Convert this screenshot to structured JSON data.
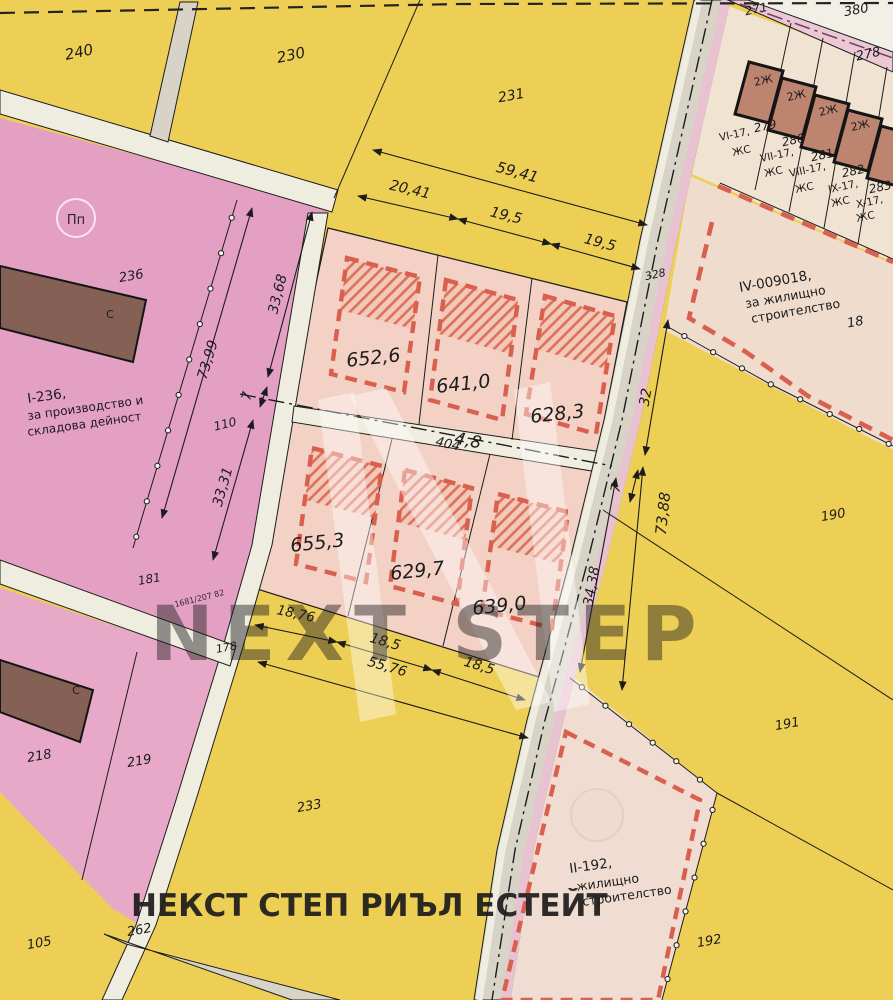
{
  "title": "Cadastral regulation plan with plots",
  "colors": {
    "yellow": "#eecf55",
    "pink_area": "#e4a0c3",
    "pink_area2": "#e7a9c7",
    "peach_block": "#f3d1c5",
    "peach_hatch_bg": "#f2c9b9",
    "tan_strip": "#f1e3d2",
    "tan_iv": "#efdccd",
    "tan_ii": "#f0dcd0",
    "road_gray": "#d7d4c7",
    "road_light": "#efece0",
    "road_pink_stripe": "#e8c2d0",
    "pink_road": "#ecc8d5",
    "paper": "#f2efe7",
    "building_terracotta": "#bd8570",
    "building_dark_brown": "#846055",
    "red_regulation": "#d95f4f",
    "hatch_red": "#dd6f5a",
    "purple_centerline": "#6e4666",
    "ink": "#1c1c1c",
    "agency_red": "#c5473a",
    "ref_red": "#d4606e"
  },
  "labels": [
    {
      "n": "parcel-240",
      "t": "240",
      "x": 80,
      "y": 57,
      "s": 15,
      "r": -12,
      "i": 1
    },
    {
      "n": "parcel-230",
      "t": "230",
      "x": 292,
      "y": 60,
      "s": 15,
      "r": -12,
      "i": 1
    },
    {
      "n": "parcel-231",
      "t": "231",
      "x": 512,
      "y": 100,
      "s": 14,
      "r": -10,
      "i": 1
    },
    {
      "n": "parcel-380",
      "t": "380",
      "x": 857,
      "y": 14,
      "s": 13,
      "r": -10,
      "i": 1
    },
    {
      "n": "parcel-271",
      "t": "271",
      "x": 757,
      "y": 13,
      "s": 12,
      "r": -12,
      "i": 1
    },
    {
      "n": "parcel-278",
      "t": "278",
      "x": 869,
      "y": 58,
      "s": 13,
      "r": -12,
      "i": 1
    },
    {
      "n": "parcel-279",
      "t": "279",
      "x": 766,
      "y": 130,
      "s": 12,
      "r": -12,
      "i": 1
    },
    {
      "n": "parcel-280",
      "t": "280",
      "x": 794,
      "y": 144,
      "s": 12,
      "r": -12,
      "i": 1
    },
    {
      "n": "parcel-281",
      "t": "281",
      "x": 823,
      "y": 159,
      "s": 12,
      "r": -12,
      "i": 1
    },
    {
      "n": "parcel-282",
      "t": "282",
      "x": 854,
      "y": 175,
      "s": 12,
      "r": -12,
      "i": 1
    },
    {
      "n": "parcel-283",
      "t": "283",
      "x": 881,
      "y": 191,
      "s": 12,
      "r": -12,
      "i": 1
    },
    {
      "n": "parcel-18",
      "t": "18",
      "x": 856,
      "y": 326,
      "s": 13,
      "r": -10,
      "i": 1
    },
    {
      "n": "parcel-190",
      "t": "190",
      "x": 834,
      "y": 519,
      "s": 13,
      "r": -10,
      "i": 1
    },
    {
      "n": "parcel-191",
      "t": "191",
      "x": 788,
      "y": 728,
      "s": 13,
      "r": -10,
      "i": 1
    },
    {
      "n": "parcel-192",
      "t": "192",
      "x": 710,
      "y": 945,
      "s": 13,
      "r": -10,
      "i": 1
    },
    {
      "n": "parcel-236",
      "t": "236",
      "x": 132,
      "y": 280,
      "s": 13,
      "r": -10,
      "i": 1
    },
    {
      "n": "parcel-110",
      "t": "110",
      "x": 226,
      "y": 428,
      "s": 12,
      "r": -14,
      "i": 1
    },
    {
      "n": "parcel-181",
      "t": "181",
      "x": 150,
      "y": 583,
      "s": 12,
      "r": -10,
      "i": 1
    },
    {
      "n": "parcel-178",
      "t": "178",
      "x": 227,
      "y": 651,
      "s": 11,
      "r": -10,
      "i": 1
    },
    {
      "n": "parcel-218",
      "t": "218",
      "x": 40,
      "y": 760,
      "s": 13,
      "r": -10,
      "i": 1
    },
    {
      "n": "parcel-219",
      "t": "219",
      "x": 140,
      "y": 765,
      "s": 13,
      "r": -10,
      "i": 1
    },
    {
      "n": "parcel-233",
      "t": "233",
      "x": 310,
      "y": 810,
      "s": 13,
      "r": -10,
      "i": 1
    },
    {
      "n": "parcel-105",
      "t": "105",
      "x": 40,
      "y": 947,
      "s": 13,
      "r": -10,
      "i": 1
    },
    {
      "n": "parcel-262",
      "t": "262",
      "x": 140,
      "y": 934,
      "s": 13,
      "r": -10,
      "i": 1
    },
    {
      "n": "parcel-328",
      "t": "328",
      "x": 656,
      "y": 278,
      "s": 11,
      "r": -12,
      "i": 1
    },
    {
      "n": "road-404-label",
      "t": "404",
      "x": 447,
      "y": 448,
      "s": 13,
      "r": 13,
      "i": 1,
      "c": "#9b988b"
    },
    {
      "n": "zone-i236-line1",
      "t": "I-236,",
      "x": 28,
      "y": 403,
      "s": 13.5,
      "r": -8,
      "a": "s"
    },
    {
      "n": "zone-i236-line2",
      "t": "за производство и",
      "x": 28,
      "y": 420,
      "s": 12,
      "r": -8,
      "a": "s"
    },
    {
      "n": "zone-i236-line3",
      "t": "складова дейност",
      "x": 28,
      "y": 436,
      "s": 12,
      "r": -8,
      "a": "s"
    },
    {
      "n": "zone-iv-line1",
      "t": "IV-009018,",
      "x": 740,
      "y": 292,
      "s": 13.5,
      "r": -10,
      "a": "s"
    },
    {
      "n": "zone-iv-line2",
      "t": "за жилищно",
      "x": 746,
      "y": 308,
      "s": 12.5,
      "r": -10,
      "a": "s"
    },
    {
      "n": "zone-iv-line3",
      "t": "строителство",
      "x": 752,
      "y": 323,
      "s": 12.5,
      "r": -10,
      "a": "s"
    },
    {
      "n": "zone-ii-line1",
      "t": "II-192,",
      "x": 570,
      "y": 873,
      "s": 13.5,
      "r": -8,
      "a": "s"
    },
    {
      "n": "zone-ii-line2",
      "t": "жилищно",
      "x": 577,
      "y": 891,
      "s": 12.5,
      "r": -8,
      "a": "s"
    },
    {
      "n": "zone-ii-line3",
      "t": "строителство",
      "x": 583,
      "y": 906,
      "s": 12.5,
      "r": -8,
      "a": "s"
    },
    {
      "n": "plot-279-use",
      "t": "VI-17,",
      "x": 720,
      "y": 141,
      "s": 10.5,
      "r": -12,
      "a": "s"
    },
    {
      "n": "plot-279-zs",
      "t": "ЖС",
      "x": 733,
      "y": 156,
      "s": 10.5,
      "r": -12,
      "a": "s"
    },
    {
      "n": "plot-280-use",
      "t": "VII-17,",
      "x": 761,
      "y": 162,
      "s": 10.5,
      "r": -12,
      "a": "s"
    },
    {
      "n": "plot-280-zs",
      "t": "ЖС",
      "x": 765,
      "y": 177,
      "s": 10.5,
      "r": -12,
      "a": "s"
    },
    {
      "n": "plot-281-use",
      "t": "VIII-17,",
      "x": 790,
      "y": 177,
      "s": 10.5,
      "r": -12,
      "a": "s"
    },
    {
      "n": "plot-281-zs",
      "t": "ЖС",
      "x": 796,
      "y": 193,
      "s": 10.5,
      "r": -12,
      "a": "s"
    },
    {
      "n": "plot-282-use",
      "t": "IX-17,",
      "x": 829,
      "y": 193,
      "s": 10.5,
      "r": -12,
      "a": "s"
    },
    {
      "n": "plot-282-zs",
      "t": "ЖС",
      "x": 832,
      "y": 207,
      "s": 10.5,
      "r": -12,
      "a": "s"
    },
    {
      "n": "plot-283-use",
      "t": "X-17,",
      "x": 857,
      "y": 208,
      "s": 10.5,
      "r": -12,
      "a": "s"
    },
    {
      "n": "plot-283-zs",
      "t": "ЖС",
      "x": 857,
      "y": 222,
      "s": 10.5,
      "r": -12,
      "a": "s"
    },
    {
      "n": "building-2j-1",
      "t": "2Ж",
      "x": 764,
      "y": 84,
      "s": 11,
      "r": -12
    },
    {
      "n": "building-2j-2",
      "t": "2Ж",
      "x": 797,
      "y": 99,
      "s": 11,
      "r": -12
    },
    {
      "n": "building-2j-3",
      "t": "2Ж",
      "x": 829,
      "y": 114,
      "s": 11,
      "r": -12
    },
    {
      "n": "building-2j-4",
      "t": "2Ж",
      "x": 861,
      "y": 129,
      "s": 11,
      "r": -12
    },
    {
      "n": "building-c-1",
      "t": "С",
      "x": 110,
      "y": 318,
      "s": 11,
      "c": "#efd3d6"
    },
    {
      "n": "building-c-2",
      "t": "С",
      "x": 76,
      "y": 694,
      "s": 11,
      "c": "#efd3d6"
    },
    {
      "n": "area-652-6",
      "t": "652,6",
      "x": 374,
      "y": 364,
      "s": 19,
      "r": -6,
      "i": 1
    },
    {
      "n": "area-641-0",
      "t": "641,0",
      "x": 464,
      "y": 390,
      "s": 19,
      "r": -6,
      "i": 1
    },
    {
      "n": "area-628-3",
      "t": "628,3",
      "x": 558,
      "y": 420,
      "s": 19,
      "r": -6,
      "i": 1
    },
    {
      "n": "area-655-3",
      "t": "655,3",
      "x": 318,
      "y": 549,
      "s": 19,
      "r": -6,
      "i": 1
    },
    {
      "n": "area-629-7",
      "t": "629,7",
      "x": 418,
      "y": 577,
      "s": 19,
      "r": -6,
      "i": 1
    },
    {
      "n": "area-639-0",
      "t": "639,0",
      "x": 500,
      "y": 612,
      "s": 19,
      "r": -6,
      "i": 1
    },
    {
      "n": "dim-59-41",
      "t": "59,41",
      "x": 516,
      "y": 177,
      "s": 15,
      "r": 15,
      "i": 1
    },
    {
      "n": "dim-20-41",
      "t": "20,41",
      "x": 409,
      "y": 194,
      "s": 14.5,
      "r": 13,
      "i": 1
    },
    {
      "n": "dim-19-5-a",
      "t": "19,5",
      "x": 505,
      "y": 220,
      "s": 14.5,
      "r": 14,
      "i": 1
    },
    {
      "n": "dim-19-5-b",
      "t": "19,5",
      "x": 599,
      "y": 247,
      "s": 14.5,
      "r": 15,
      "i": 1
    },
    {
      "n": "dim-33-68",
      "t": "33,68",
      "x": 282,
      "y": 295,
      "s": 14,
      "r": -76,
      "i": 1
    },
    {
      "n": "dim-7-left",
      "t": "7",
      "x": 251,
      "y": 397,
      "s": 13,
      "r": -76,
      "i": 1
    },
    {
      "n": "dim-33-31",
      "t": "33,31",
      "x": 227,
      "y": 488,
      "s": 14,
      "r": -74,
      "i": 1
    },
    {
      "n": "dim-73-99",
      "t": "73,99",
      "x": 212,
      "y": 361,
      "s": 14,
      "r": -73,
      "i": 1
    },
    {
      "n": "dim-32",
      "t": "32",
      "x": 650,
      "y": 398,
      "s": 14,
      "r": -80,
      "i": 1
    },
    {
      "n": "dim-7-right",
      "t": "7",
      "x": 620,
      "y": 489,
      "s": 13,
      "r": -78,
      "i": 1
    },
    {
      "n": "dim-73-88",
      "t": "73,88",
      "x": 668,
      "y": 514,
      "s": 15,
      "r": -84,
      "i": 1
    },
    {
      "n": "dim-34-38",
      "t": "34,38",
      "x": 596,
      "y": 587,
      "s": 14,
      "r": -80,
      "i": 1
    },
    {
      "n": "dim-18-76",
      "t": "18,76",
      "x": 295,
      "y": 618,
      "s": 13.5,
      "r": 12,
      "i": 1
    },
    {
      "n": "dim-18-5-a",
      "t": "18,5",
      "x": 384,
      "y": 646,
      "s": 14,
      "r": 16,
      "i": 1
    },
    {
      "n": "dim-18-5-b",
      "t": "18,5",
      "x": 478,
      "y": 670,
      "s": 14,
      "r": 17,
      "i": 1
    },
    {
      "n": "dim-55-76",
      "t": "55,76",
      "x": 386,
      "y": 671,
      "s": 14,
      "r": 16,
      "i": 1
    },
    {
      "n": "dim-4-8",
      "t": "4,8",
      "x": 467,
      "y": 446,
      "s": 17,
      "r": 11,
      "i": 1
    },
    {
      "n": "wm-ref-number",
      "t": "1681/207 82",
      "x": 200,
      "y": 601,
      "s": 8,
      "r": -14,
      "c": "#d4606e",
      "o": 0.9
    },
    {
      "n": "wm-next-step",
      "t": "NEXT STEP",
      "x": 150,
      "y": 660,
      "s": 76,
      "a": "s",
      "w": 1,
      "c": "#ffffff",
      "o": 0.45,
      "ls": 10
    },
    {
      "n": "wm-agency",
      "t": "НЕКСТ СТЕП РИЪЛ ЕСТЕЙТ",
      "x": 131,
      "y": 916,
      "s": 31,
      "a": "s",
      "w": 1,
      "c": "#c5473a",
      "o": 0.92
    },
    {
      "n": "stamp-pp",
      "t": "Пп",
      "x": 76,
      "y": 224,
      "s": 13,
      "c": "#f8e8f2",
      "o": 0.95
    }
  ]
}
